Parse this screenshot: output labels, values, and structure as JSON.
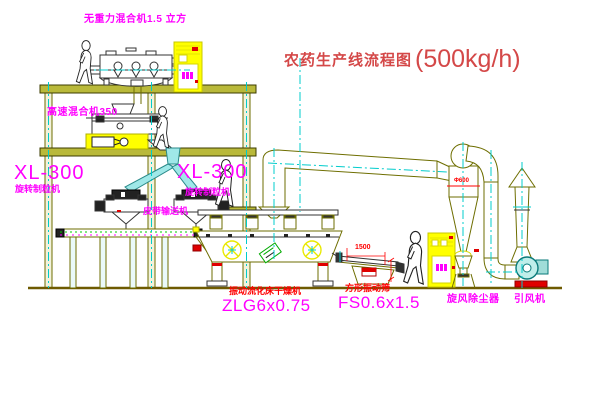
{
  "title": {
    "text": "农药生产线流程图",
    "capacity": "(500kg/h)"
  },
  "labels": {
    "gravity_mixer": "无重力混合机1.5 立方",
    "high_speed_mixer": "高速混合机350",
    "granulator_left_model": "XL-300",
    "granulator_left_name": "旋转制粒机",
    "granulator_right_model": "XL-300",
    "granulator_right_name": "旋转制粒机",
    "belt_conveyor": "皮带输送机",
    "dryer_name": "振动流化床干燥机",
    "dryer_model": "ZLG6x0.75",
    "sieve_name": "方形振动筛",
    "sieve_model": "FS0.6x1.5",
    "cyclone_collector": "旋风除尘器",
    "induced_draft_fan": "引风机"
  },
  "dimensions": {
    "sieve_length": "1500",
    "cyclone_diameter": "Φ600"
  },
  "colors": {
    "cad_line_olive": "#808000",
    "centerline_cyan": "#00cccc",
    "highlight_yellow": "#ffff00",
    "label_magenta": "#ff00ff",
    "label_red": "#ff0000",
    "title_red": "#d44848",
    "detail_green": "#00aa00"
  }
}
